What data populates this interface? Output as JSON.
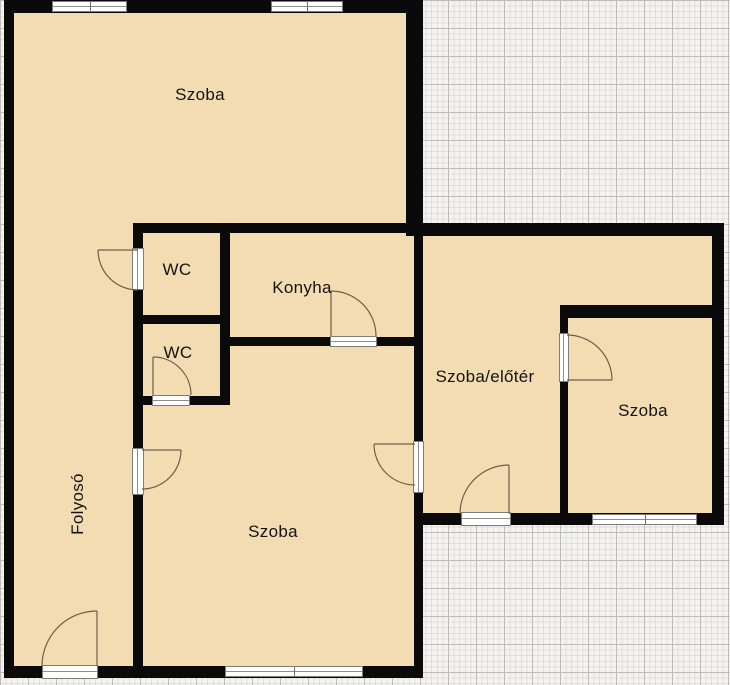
{
  "plan": {
    "kind_label": "apartment floor plan",
    "colors": {
      "floor_fill": "#f3dcb2",
      "wall": "#0a0a0a",
      "door_arc": "#6a5f4c",
      "grid_background": "#f4f3f0",
      "grid_line_minor": "#d2d0cb",
      "grid_line_major": "#b9b7b2",
      "opening_fill": "#ffffff"
    },
    "counts": {
      "doors": 8,
      "windows": 4
    }
  },
  "rooms": [
    {
      "name": "szoba-top",
      "label": "Szoba"
    },
    {
      "name": "wc-upper",
      "label": "WC"
    },
    {
      "name": "konyha",
      "label": "Konyha"
    },
    {
      "name": "wc-lower",
      "label": "WC"
    },
    {
      "name": "folyoso",
      "label": "Folyosó"
    },
    {
      "name": "szoba-bottom",
      "label": "Szoba"
    },
    {
      "name": "szoba-eloter",
      "label": "Szoba/előtér"
    },
    {
      "name": "szoba-right",
      "label": "Szoba"
    }
  ]
}
